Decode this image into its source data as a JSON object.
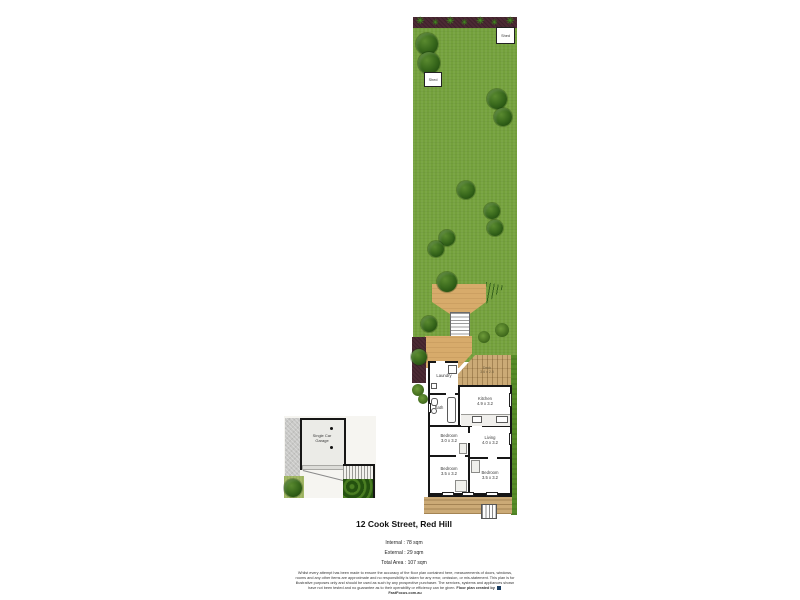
{
  "palette": {
    "lawn": "#74a13c",
    "garden_bed": "#4c2a34",
    "plant_green": "#41941f",
    "tree_dark": "#2c5716",
    "deck_tan": "#d7ab6b",
    "deck_wood": "#cbaa76",
    "wall": "#161616",
    "hedge": "#2d5a15",
    "concrete": "#c8c8c6"
  },
  "garden": {
    "sheds": [
      "Shed",
      "Shed"
    ]
  },
  "rooms": {
    "laundry": {
      "name": "Laundry"
    },
    "bath": {
      "name": "Bath"
    },
    "kitchen": {
      "name": "Kitchen",
      "dims": "4.9 x 3.2"
    },
    "living": {
      "name": "Living",
      "dims": "4.0 x 3.2"
    },
    "bedroom1": {
      "name": "Bedroom",
      "dims": "3.0 x 3.2"
    },
    "bedroom2": {
      "name": "Bedroom",
      "dims": "3.5 x 3.2"
    },
    "bedroom3": {
      "name": "Bedroom",
      "dims": "3.5 x 3.2"
    },
    "deck": {
      "name": "Deck",
      "dims": "3.6 x 2.5"
    },
    "garage": {
      "name": "Single Car Garage"
    }
  },
  "title": "12 Cook Street, Red Hill",
  "areas": {
    "internal": "Internal : 78 sqm",
    "external": "External : 29 sqm",
    "total": "Total Area : 107 sqm"
  },
  "disclaimer": {
    "body": "Whilst every attempt has been made to ensure the accuracy of the floor plan contained here, measurements of doors, windows, rooms and any other items are approximate and no responsibility is taken for any error, omission, or mis-statement. This plan is for illustrative purposes only and should be used as such by any prospective purchaser. The services, systems and appliances shown have not been tested and no guarantee as to their operability or efficiency can be given.",
    "credit_prefix": "Floor plan created by",
    "credit_brand": "FastFocus.com.au"
  }
}
